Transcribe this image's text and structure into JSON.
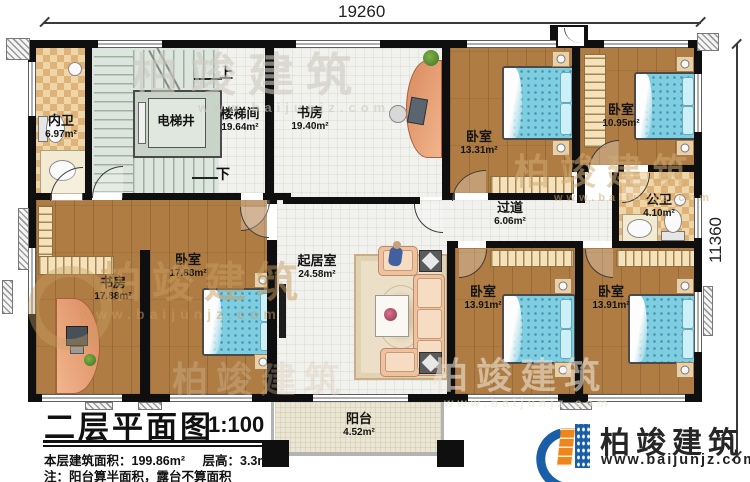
{
  "dimensions": {
    "width_label": "19260",
    "height_label": "11360"
  },
  "stairs": {
    "up": "上",
    "down": "下",
    "elevator": "电梯井"
  },
  "rooms": {
    "neiwei": {
      "name": "内卫",
      "area": "6.97m²"
    },
    "loutijian": {
      "name": "楼梯间",
      "area": "19.64m²"
    },
    "shufang_top": {
      "name": "书房",
      "area": "19.40m²"
    },
    "woshi_1331": {
      "name": "卧室",
      "area": "13.31m²"
    },
    "woshi_1095": {
      "name": "卧室",
      "area": "10.95m²"
    },
    "gongwei": {
      "name": "公卫",
      "area": "4.10m²"
    },
    "guodao": {
      "name": "过道",
      "area": "6.06m²"
    },
    "qijushi": {
      "name": "起居室",
      "area": "24.58m²"
    },
    "shufang_bottom": {
      "name": "书房",
      "area": "17.88m²"
    },
    "woshi_1788": {
      "name": "卧室",
      "area": "17.88m²"
    },
    "woshi_1391a": {
      "name": "卧室",
      "area": "13.91m²"
    },
    "woshi_1391b": {
      "name": "卧室",
      "area": "13.91m²"
    },
    "yangtai": {
      "name": "阳台",
      "area": "4.52m²"
    }
  },
  "title_block": {
    "title": "二层平面图",
    "scale": "1:100",
    "area_label": "本层建筑面积：199.86m²",
    "height_label": "层高：3.3m",
    "note": "注：阳台算半面积，露台不算面积"
  },
  "brand": {
    "name": "柏竣建筑",
    "website": "www.baijunjz.com"
  },
  "watermark": {
    "name": "柏竣建筑",
    "website": "www.baijunjz.com"
  }
}
